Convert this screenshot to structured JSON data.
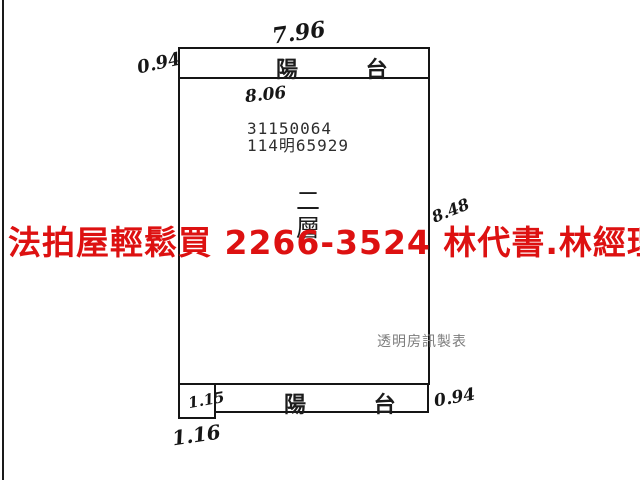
{
  "overlay": {
    "red_ad_text": "法拍屋輕鬆買  2266-3524  林代書.林經理",
    "red_color": "#dd1111"
  },
  "plan": {
    "balcony_top_label": "陽 台",
    "balcony_bottom_label": "陽 台",
    "floor_label": "二層",
    "serial_line1": "31150064",
    "serial_line2": "114明65929",
    "maker_note": "透明房訊製表",
    "dimensions": {
      "top_width": "7.96",
      "top_left_height": "0.94",
      "inner_width": "8.06",
      "right_height": "8.48",
      "bottom_left_inner": "1.15",
      "bottom_right": "0.94",
      "bottom_left_outer": "1.16"
    },
    "line_color": "#151515"
  }
}
